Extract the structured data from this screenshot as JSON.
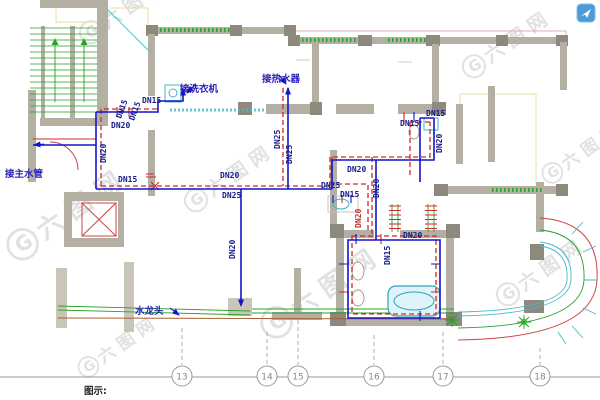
{
  "watermark": {
    "monogram": "G",
    "brand": "六图网",
    "logo_icon": "paper-plane-icon",
    "logo_color": "#4a9bd8"
  },
  "legend": {
    "label": "图示:"
  },
  "annotations": {
    "main_water_pipe": "接主水管",
    "washing_machine": "接洗衣机",
    "water_heater": "接热水器",
    "faucet": "水龙头"
  },
  "pipe_labels": [
    "DN15",
    "DN15",
    "DN20",
    "DN15",
    "DN20",
    "DN15",
    "DN20",
    "DN25",
    "DN20",
    "DN25",
    "DN25",
    "DN20",
    "DN25",
    "DN15",
    "DN20",
    "DN20",
    "DN15",
    "DN15",
    "DN20",
    "DN20",
    "DN15"
  ],
  "grid_axes": [
    "13",
    "14",
    "15",
    "16",
    "17",
    "18"
  ],
  "colors": {
    "cold_water_pipe": "#1515c8",
    "hot_water_pipe": "#d02a2a",
    "wall": "#b3afa3",
    "window": "#2aa02a",
    "fixture": "#3bb8c4",
    "label_text": "#151a8c",
    "annotation_text": "#2a22b8"
  }
}
